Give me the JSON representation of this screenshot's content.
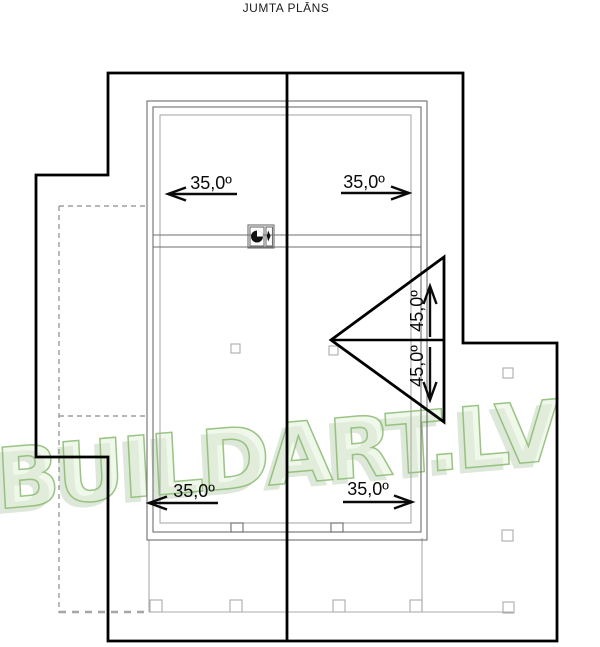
{
  "title": "JUMTA PLĀNS",
  "watermark": {
    "text": "BUILDART.LV"
  },
  "slope_labels": {
    "top_left": "35,0º",
    "top_right": "35,0º",
    "bottom_left": "35,0º",
    "bottom_right": "35,0º",
    "gable_upper": "45,0º",
    "gable_lower": "45,0º"
  },
  "icons": {
    "chimney": "chimney-flue-symbol"
  },
  "colors": {
    "background": "#ffffff",
    "outline": "#000000",
    "thin_line": "#6e6e6e",
    "light_line": "#ababab",
    "watermark_green": "#8aba6e"
  }
}
